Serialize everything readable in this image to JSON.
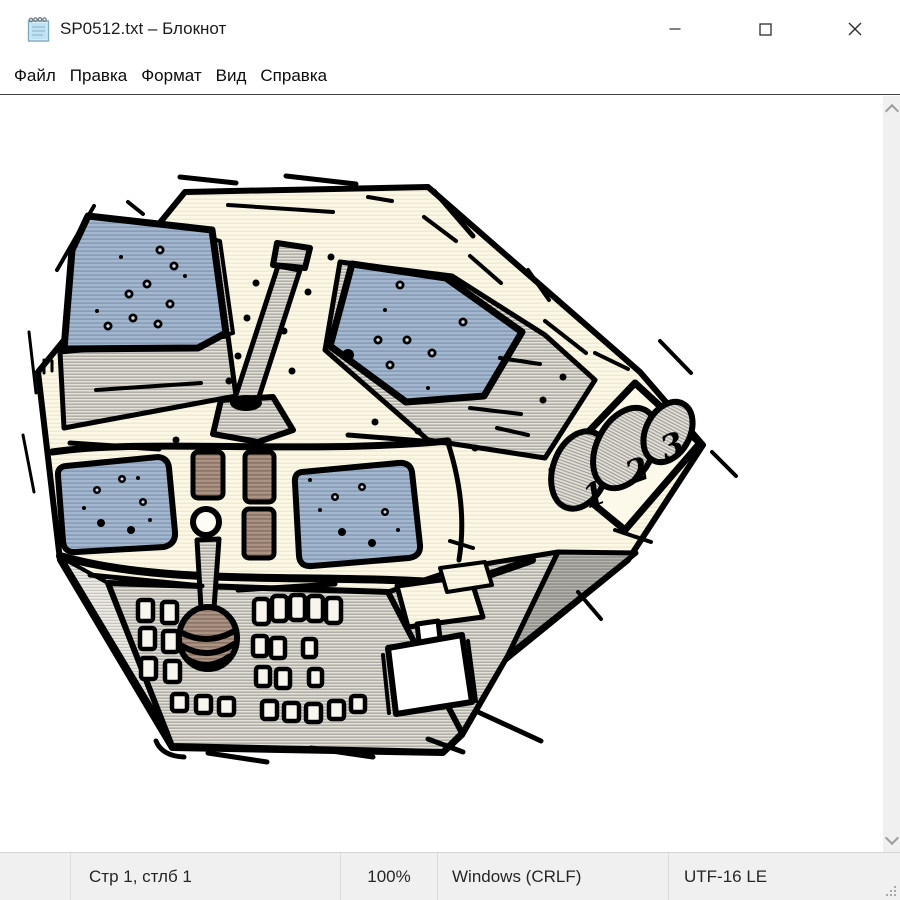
{
  "window": {
    "title": "SP0512.txt – Блокнот"
  },
  "menu": {
    "items": [
      "Файл",
      "Правка",
      "Формат",
      "Вид",
      "Справка"
    ]
  },
  "editor": {
    "illustration": {
      "type": "halftone-clipart-spacecraft-control-console",
      "keypad_labels": [
        "1",
        "2",
        "3"
      ],
      "colors": {
        "paper_cream": "#fcf8e5",
        "panel_blue": "#a3b7cf",
        "metal_gray": "#d9d7d0",
        "side_gray": "#b7b5b0",
        "knob_brown": "#ab9384",
        "outline_ink": "#000000"
      }
    }
  },
  "status_bar": {
    "cursor_position": "Стр 1, стлб 1",
    "zoom_level": "100%",
    "line_endings": "Windows (CRLF)",
    "encoding": "UTF-16 LE"
  }
}
